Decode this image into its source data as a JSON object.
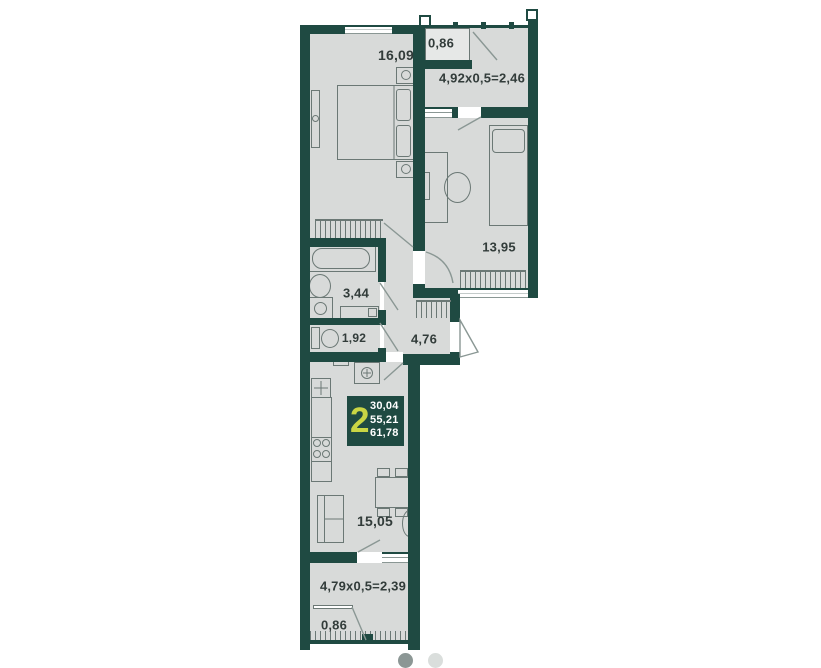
{
  "plan": {
    "type": "apartment-floor-plan",
    "unit_badge": {
      "rooms_count": "2",
      "area_living": "30,04",
      "area_main": "55,21",
      "area_total": "61,78"
    },
    "rooms": {
      "bedroom_main": "16,09",
      "balcony_top_closet": "0,86",
      "balcony_top": "4,92x0,5=2,46",
      "bedroom_second": "13,95",
      "bathroom": "3,44",
      "toilet": "1,92",
      "hall": "4,76",
      "kitchen_living": "15,05",
      "balcony_bottom": "4,79x0,5=2,39",
      "balcony_bottom_closet": "0,86"
    },
    "colors": {
      "wall": "#1f4a42",
      "room_fill": "#d8dad9",
      "accent": "#c9d544",
      "label": "#323c3a",
      "dot_active": "#8c9795",
      "dot_inactive": "#dadedc"
    }
  },
  "carousel": {
    "dots": [
      {
        "state": "active"
      },
      {
        "state": "inactive"
      }
    ]
  }
}
